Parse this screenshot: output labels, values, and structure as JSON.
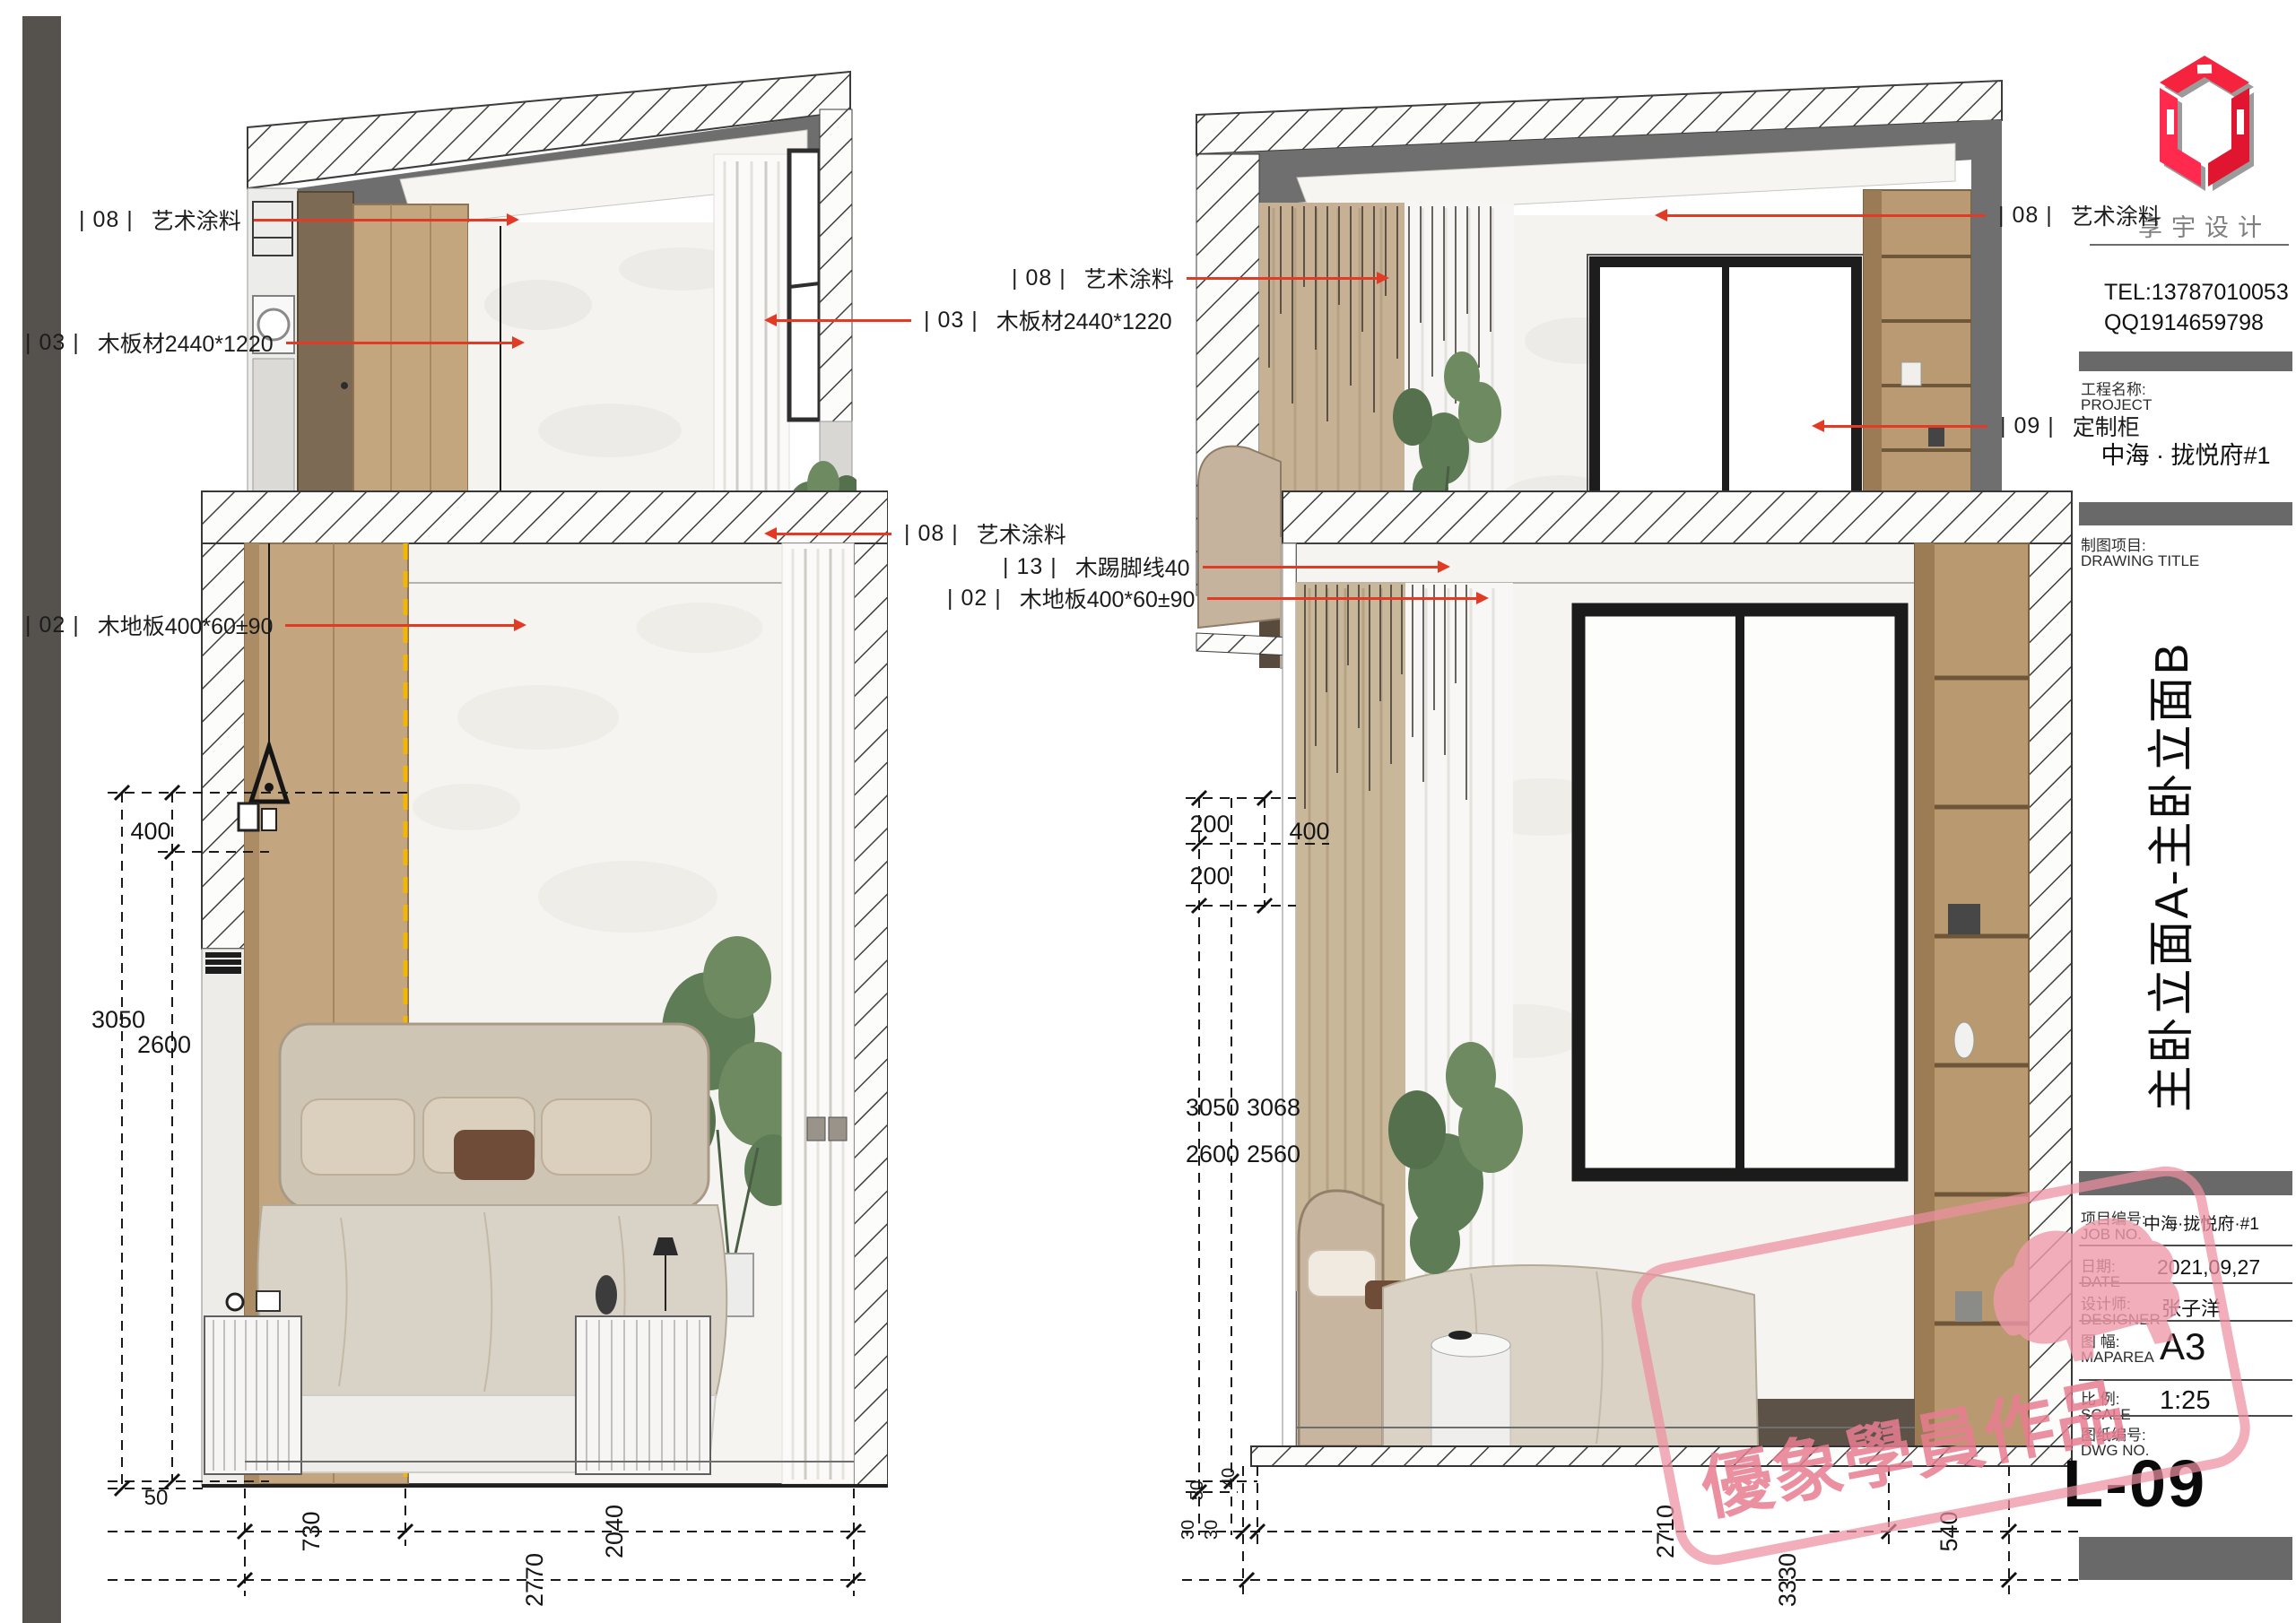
{
  "colors": {
    "accent_red": "#e23b25",
    "section_line_yellow": "#f2b705",
    "stamp_pink": "#ec8ba0",
    "titlebar_gray": "#696969",
    "page_edge_bar": "#55514d"
  },
  "brand": {
    "logo_text": "享宇设计",
    "tel": "TEL:13787010053",
    "qq": "QQ1914659798"
  },
  "title_block": {
    "project_label_cn": "工程名称:",
    "project_label_en": "PROJECT",
    "project_name": "中海 · 拢悦府#1",
    "drawing_label_cn": "制图项目:",
    "drawing_label_en": "DRAWING TITLE",
    "drawing_title": "主卧立面A-主卧立面B",
    "rows": [
      {
        "label_cn": "项目编号:",
        "label_en": "JOB NO.",
        "value": "中海·拢悦府·#1"
      },
      {
        "label_cn": "日期:",
        "label_en": "DATE",
        "value": "2021,09,27"
      },
      {
        "label_cn": "设计师:",
        "label_en": "DESIGNER",
        "value": "张子洋"
      },
      {
        "label_cn": "图 幅:",
        "label_en": "MAPAREA",
        "value": "A3"
      },
      {
        "label_cn": "比 例:",
        "label_en": "SCALE",
        "value": "1:25"
      },
      {
        "label_cn": "图纸编号:",
        "label_en": "DWG NO.",
        "value": ""
      }
    ],
    "sheet_no": "L-09"
  },
  "watermark": {
    "text": "優象學員作品"
  },
  "annotations": {
    "a1": {
      "code": "| 08 |",
      "text": "艺术涂料"
    },
    "a2": {
      "code": "| 03 |",
      "text": "木板材2440*1220"
    },
    "a3": {
      "code": "| 02 |",
      "text": "木地板400*60±90"
    },
    "m1": {
      "code": "| 08 |",
      "text": "艺术涂料"
    },
    "m2": {
      "code": "| 03 |",
      "text": "木板材2440*1220"
    },
    "m3": {
      "code": "| 08 |",
      "text": "艺术涂料"
    },
    "m4": {
      "code": "| 13 |",
      "text": "木踢脚线40"
    },
    "m5": {
      "code": "| 02 |",
      "text": "木地板400*60±90"
    },
    "r1": {
      "code": "| 08 |",
      "text": "艺术涂料"
    },
    "r2": {
      "code": "| 09 |",
      "text": "定制柜"
    }
  },
  "dims_a": {
    "top": "400",
    "total": "3050",
    "clear": "2600",
    "floor": "50",
    "w1": "730",
    "w2": "2040",
    "w_total": "2770"
  },
  "dims_b": {
    "c1": "200",
    "c2": "200",
    "c_total": "400",
    "total_a": "3050",
    "total_b": "3068",
    "clear_a": "2600",
    "clear_b": "2560",
    "skirt": "40",
    "floor": "50",
    "s1": "30",
    "s2": "30",
    "w1": "2710",
    "w2": "540",
    "w_total": "3330"
  }
}
